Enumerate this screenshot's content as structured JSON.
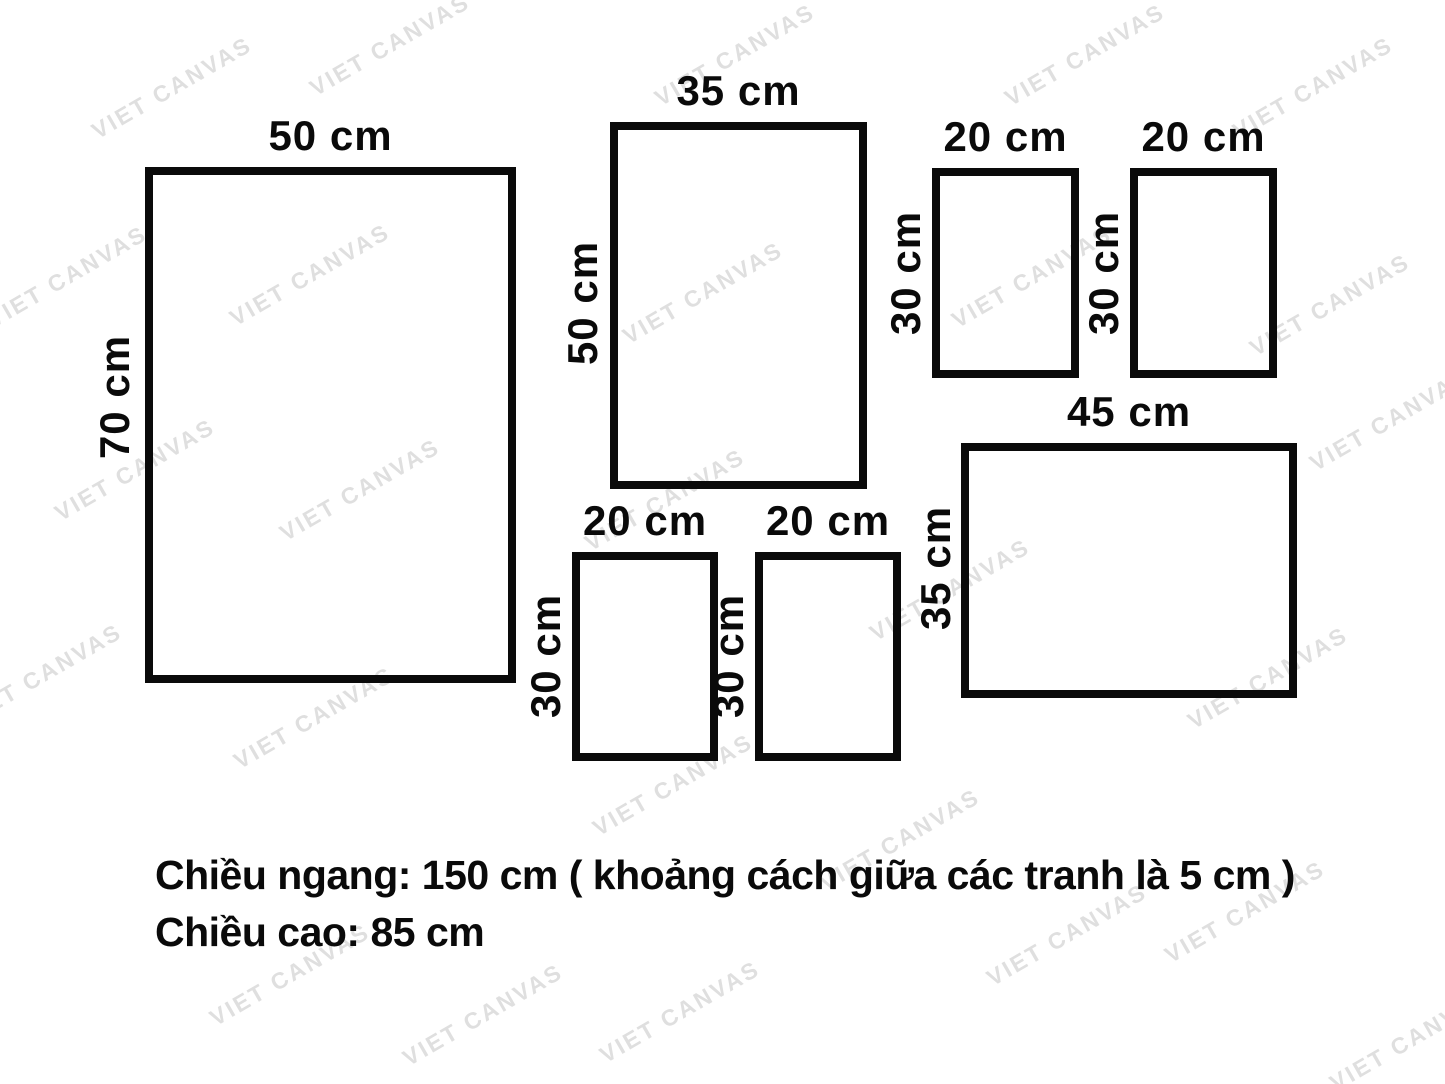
{
  "watermark": {
    "text": "VIET CANVAS",
    "color": "#dfdfdf"
  },
  "diagram": {
    "line_color": "#0a0a0a",
    "frames": [
      {
        "name": "frame-50x70",
        "width_label": "50 cm",
        "height_label": "70 cm"
      },
      {
        "name": "frame-35x50",
        "width_label": "35 cm",
        "height_label": "50 cm"
      },
      {
        "name": "frame-20x30-top-left",
        "width_label": "20 cm",
        "height_label": "30 cm"
      },
      {
        "name": "frame-20x30-top-right",
        "width_label": "20 cm",
        "height_label": "30 cm"
      },
      {
        "name": "frame-45x35",
        "width_label": "45 cm",
        "height_label": "35 cm"
      },
      {
        "name": "frame-20x30-bottom-left",
        "width_label": "20 cm",
        "height_label": "30 cm"
      },
      {
        "name": "frame-20x30-bottom-right",
        "width_label": "20 cm",
        "height_label": "30 cm"
      }
    ]
  },
  "notes": {
    "line1": "Chiều ngang: 150 cm ( khoảng cách giữa các tranh là 5 cm )",
    "line2": "Chiều cao: 85 cm"
  }
}
